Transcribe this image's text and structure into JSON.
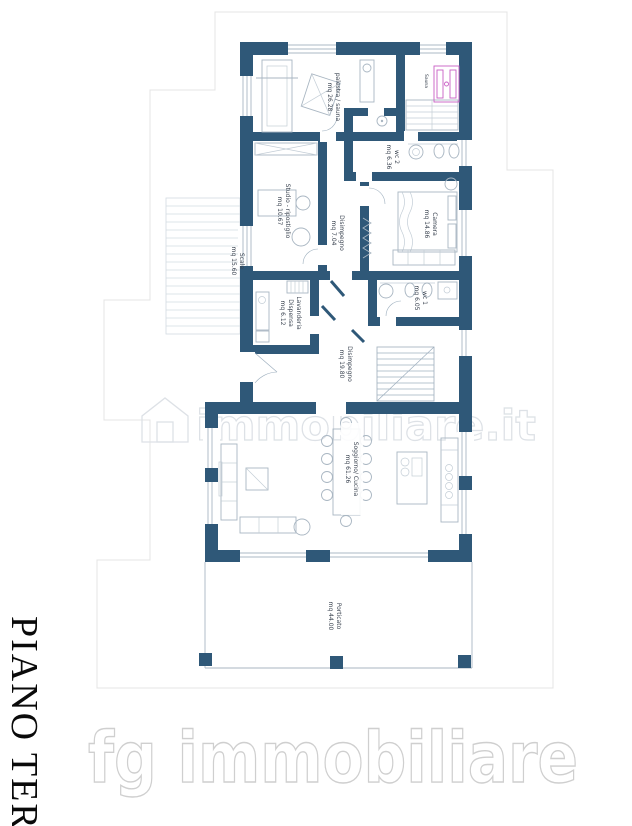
{
  "page": {
    "floor_title": "PIANO TERR"
  },
  "watermark": {
    "center_text": "immobiliare.it",
    "bottom_text": "fg immobiliare"
  },
  "rooms": [
    {
      "name": "palestra / sauna",
      "area": "mq 26.28"
    },
    {
      "name": "Sauna",
      "area": ""
    },
    {
      "name": "wc 2",
      "area": "mq 6.36"
    },
    {
      "name": "Camera",
      "area": "mq 14.86"
    },
    {
      "name": "Studio - ripostiglio",
      "area": "mq 10.67"
    },
    {
      "name": "Disimpegno",
      "area": "mq 7.04"
    },
    {
      "name": "Scale",
      "area": "mq 15.60"
    },
    {
      "name": "Lavanderia",
      "sublabel": "Dispensa",
      "area": "mq 6.12"
    },
    {
      "name": "wc 1",
      "area": "mq 6.05"
    },
    {
      "name": "Disimpegno",
      "area": "mq 19.80"
    },
    {
      "name": "Soggiorno/ Cucina",
      "area": "mq 61.26"
    },
    {
      "name": "Porticato",
      "area": "mq 44.00"
    }
  ],
  "colors": {
    "wall": "#2f5878",
    "furniture_line": "#a9b6c2",
    "sauna_fixture": "#c95fc5",
    "watermark": "#d9dde1",
    "paper_frame": "#e4e4e4",
    "label_text": "#3a4350"
  }
}
